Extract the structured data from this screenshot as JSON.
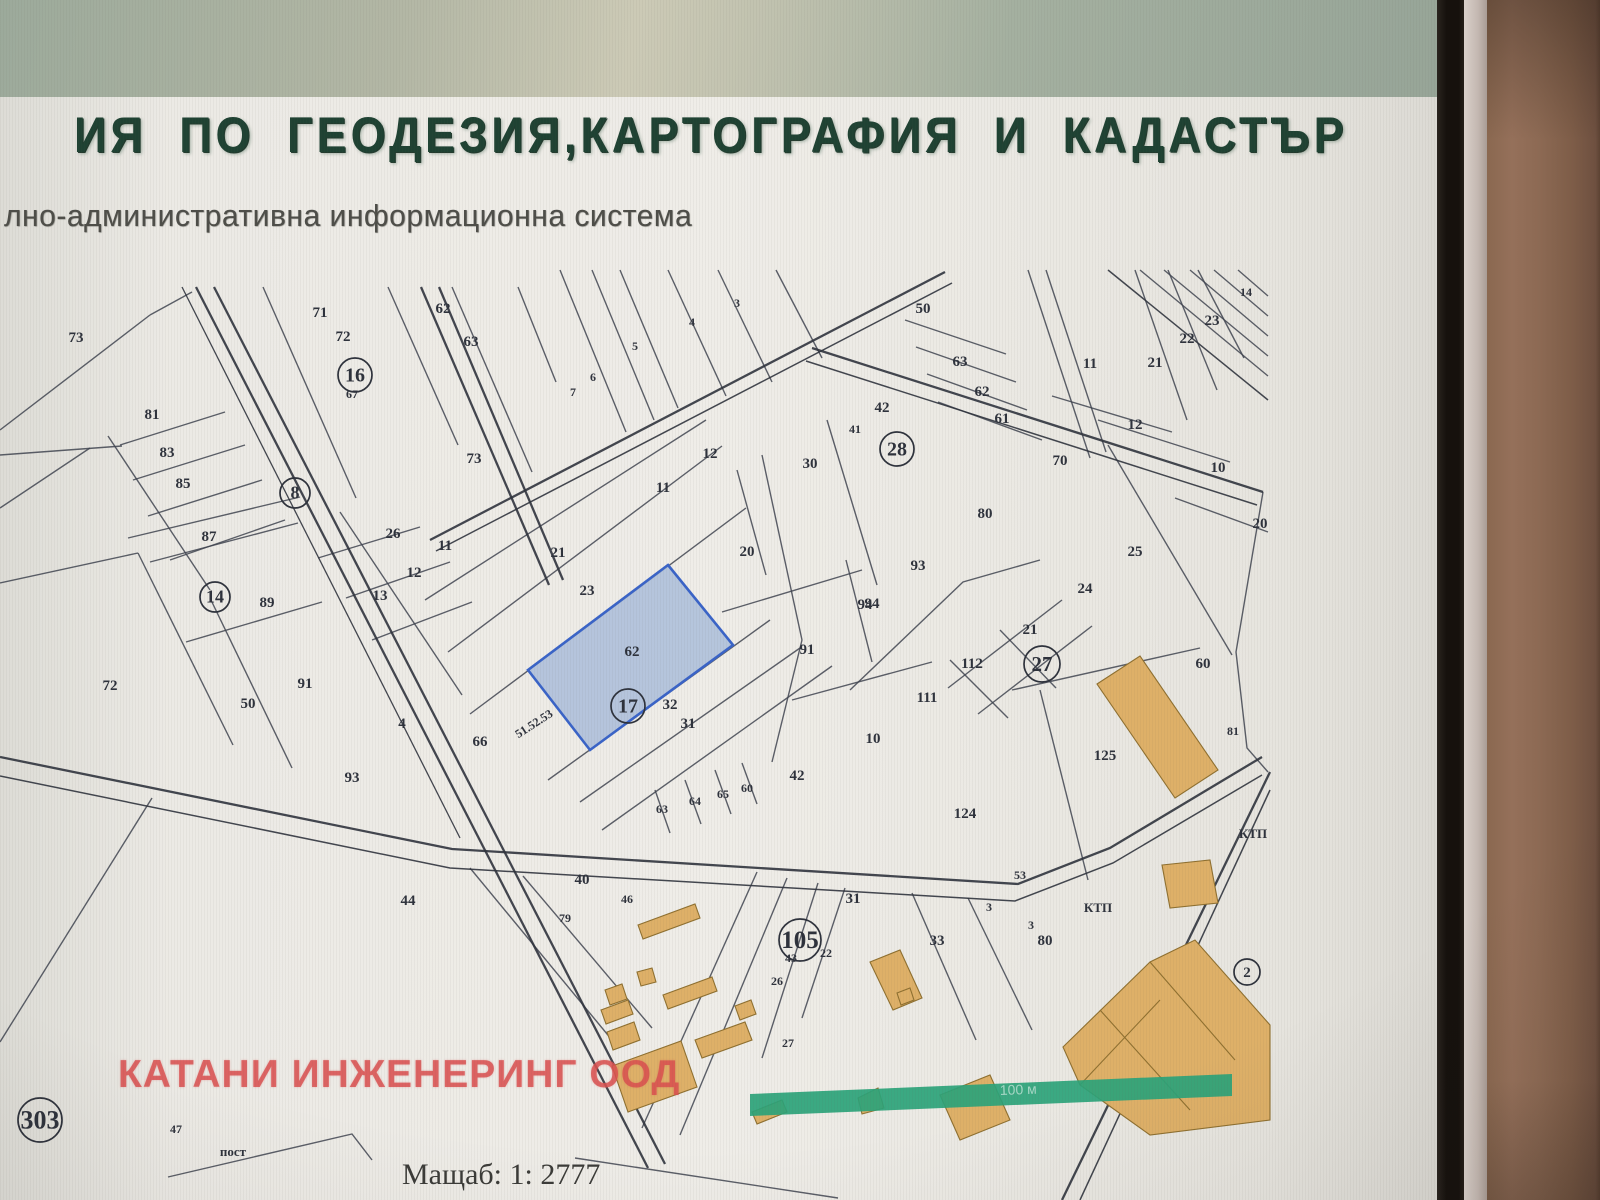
{
  "header": {
    "title": "ИЯ ПО ГЕОДЕЗИЯ,КАРТОГРАФИЯ И КАДАСТЪР",
    "subtitle": "лно-административна информационна система"
  },
  "map": {
    "scale_text": "Мащаб: 1: 2777",
    "watermark": "КАТАНИ ИНЖЕНЕРИНГ ООД",
    "scalebar_label": "100 м",
    "highlighted_parcel": {
      "number": "62",
      "companion_circled": "17"
    },
    "colors": {
      "title_green": "#1f4233",
      "line": "#3f4450",
      "road": "#2f333d",
      "highlight_fill": "#aabdd9",
      "highlight_border": "#3a64c8",
      "building_fill": "#deb068",
      "building_stroke": "#8f7030",
      "scalebar_green": "#2ba379",
      "watermark_red": "#d94f4f"
    },
    "labels": [
      {
        "t": "73",
        "x": 76,
        "y": 342
      },
      {
        "t": "71",
        "x": 320,
        "y": 317
      },
      {
        "t": "72",
        "x": 343,
        "y": 341
      },
      {
        "t": "67",
        "x": 352,
        "y": 398,
        "s": 1
      },
      {
        "t": "62",
        "x": 443,
        "y": 313
      },
      {
        "t": "63",
        "x": 471,
        "y": 346
      },
      {
        "t": "81",
        "x": 152,
        "y": 419
      },
      {
        "t": "83",
        "x": 167,
        "y": 457
      },
      {
        "t": "85",
        "x": 183,
        "y": 488
      },
      {
        "t": "87",
        "x": 209,
        "y": 541
      },
      {
        "t": "89",
        "x": 267,
        "y": 607
      },
      {
        "t": "26",
        "x": 393,
        "y": 538
      },
      {
        "t": "11",
        "x": 445,
        "y": 550
      },
      {
        "t": "12",
        "x": 414,
        "y": 577
      },
      {
        "t": "13",
        "x": 380,
        "y": 600
      },
      {
        "t": "72",
        "x": 110,
        "y": 690
      },
      {
        "t": "50",
        "x": 248,
        "y": 708
      },
      {
        "t": "91",
        "x": 305,
        "y": 688
      },
      {
        "t": "93",
        "x": 352,
        "y": 782
      },
      {
        "t": "4",
        "x": 402,
        "y": 728
      },
      {
        "t": "66",
        "x": 480,
        "y": 746
      },
      {
        "t": "7",
        "x": 573,
        "y": 396,
        "s": 1
      },
      {
        "t": "6",
        "x": 593,
        "y": 381,
        "s": 1
      },
      {
        "t": "5",
        "x": 635,
        "y": 350,
        "s": 1
      },
      {
        "t": "4",
        "x": 692,
        "y": 326,
        "s": 1
      },
      {
        "t": "3",
        "x": 737,
        "y": 307,
        "s": 1
      },
      {
        "t": "73",
        "x": 474,
        "y": 463
      },
      {
        "t": "12",
        "x": 710,
        "y": 458
      },
      {
        "t": "11",
        "x": 663,
        "y": 492
      },
      {
        "t": "30",
        "x": 810,
        "y": 468
      },
      {
        "t": "21",
        "x": 558,
        "y": 557
      },
      {
        "t": "23",
        "x": 587,
        "y": 595
      },
      {
        "t": "62",
        "x": 632,
        "y": 656
      },
      {
        "t": "32",
        "x": 670,
        "y": 709
      },
      {
        "t": "31",
        "x": 688,
        "y": 728
      },
      {
        "t": "20",
        "x": 747,
        "y": 556
      },
      {
        "t": "91",
        "x": 807,
        "y": 654
      },
      {
        "t": "94",
        "x": 872,
        "y": 608
      },
      {
        "t": "10",
        "x": 873,
        "y": 743
      },
      {
        "t": "42",
        "x": 797,
        "y": 780
      },
      {
        "t": "63",
        "x": 662,
        "y": 813,
        "s": 1
      },
      {
        "t": "64",
        "x": 695,
        "y": 805,
        "s": 1
      },
      {
        "t": "65",
        "x": 723,
        "y": 798,
        "s": 1
      },
      {
        "t": "60",
        "x": 747,
        "y": 792,
        "s": 1
      },
      {
        "t": "51.52.53",
        "x": 536,
        "y": 727,
        "s": 1,
        "rot": -33
      },
      {
        "t": "50",
        "x": 923,
        "y": 313
      },
      {
        "t": "63",
        "x": 960,
        "y": 366
      },
      {
        "t": "62",
        "x": 982,
        "y": 396
      },
      {
        "t": "61",
        "x": 1002,
        "y": 423
      },
      {
        "t": "42",
        "x": 882,
        "y": 412
      },
      {
        "t": "41",
        "x": 855,
        "y": 433,
        "s": 1
      },
      {
        "t": "11",
        "x": 1090,
        "y": 368
      },
      {
        "t": "21",
        "x": 1155,
        "y": 367
      },
      {
        "t": "22",
        "x": 1187,
        "y": 343
      },
      {
        "t": "23",
        "x": 1212,
        "y": 325
      },
      {
        "t": "14",
        "x": 1246,
        "y": 296,
        "s": 1
      },
      {
        "t": "12",
        "x": 1135,
        "y": 429
      },
      {
        "t": "70",
        "x": 1060,
        "y": 465
      },
      {
        "t": "10",
        "x": 1218,
        "y": 472
      },
      {
        "t": "80",
        "x": 985,
        "y": 518
      },
      {
        "t": "20",
        "x": 1260,
        "y": 528
      },
      {
        "t": "25",
        "x": 1135,
        "y": 556
      },
      {
        "t": "24",
        "x": 1085,
        "y": 593
      },
      {
        "t": "93",
        "x": 918,
        "y": 570
      },
      {
        "t": "94",
        "x": 865,
        "y": 609
      },
      {
        "t": "21",
        "x": 1030,
        "y": 634
      },
      {
        "t": "112",
        "x": 972,
        "y": 668
      },
      {
        "t": "111",
        "x": 927,
        "y": 702
      },
      {
        "t": "60",
        "x": 1203,
        "y": 668
      },
      {
        "t": "81",
        "x": 1233,
        "y": 735,
        "s": 1
      },
      {
        "t": "125",
        "x": 1105,
        "y": 760
      },
      {
        "t": "124",
        "x": 965,
        "y": 818
      },
      {
        "t": "53",
        "x": 1020,
        "y": 879,
        "s": 1
      },
      {
        "t": "40",
        "x": 582,
        "y": 884
      },
      {
        "t": "46",
        "x": 627,
        "y": 903,
        "s": 1
      },
      {
        "t": "79",
        "x": 565,
        "y": 922,
        "s": 1
      },
      {
        "t": "44",
        "x": 408,
        "y": 905
      },
      {
        "t": "31",
        "x": 853,
        "y": 903
      },
      {
        "t": "33",
        "x": 937,
        "y": 945
      },
      {
        "t": "3",
        "x": 989,
        "y": 911,
        "s": 1
      },
      {
        "t": "3",
        "x": 1031,
        "y": 929,
        "s": 1
      },
      {
        "t": "43",
        "x": 791,
        "y": 962,
        "s": 1
      },
      {
        "t": "22",
        "x": 826,
        "y": 957,
        "s": 1
      },
      {
        "t": "26",
        "x": 777,
        "y": 985,
        "s": 1
      },
      {
        "t": "27",
        "x": 788,
        "y": 1047,
        "s": 1
      },
      {
        "t": "80",
        "x": 1045,
        "y": 945
      },
      {
        "t": "47",
        "x": 176,
        "y": 1133,
        "s": 1
      }
    ],
    "circled_labels": [
      {
        "t": "16",
        "x": 355,
        "y": 375,
        "r": 17
      },
      {
        "t": "8",
        "x": 295,
        "y": 493,
        "r": 15
      },
      {
        "t": "14",
        "x": 215,
        "y": 597,
        "r": 15
      },
      {
        "t": "17",
        "x": 628,
        "y": 706,
        "r": 17
      },
      {
        "t": "28",
        "x": 897,
        "y": 449,
        "r": 17
      },
      {
        "t": "27",
        "x": 1042,
        "y": 664,
        "r": 18
      },
      {
        "t": "105",
        "x": 800,
        "y": 940,
        "r": 21
      },
      {
        "t": "303",
        "x": 40,
        "y": 1120,
        "r": 22
      },
      {
        "t": "2",
        "x": 1247,
        "y": 972,
        "r": 13
      }
    ],
    "texts": [
      {
        "t": "КТП",
        "x": 1253,
        "y": 838
      },
      {
        "t": "КТП",
        "x": 1098,
        "y": 912
      },
      {
        "t": "пост",
        "x": 233,
        "y": 1156
      }
    ]
  }
}
